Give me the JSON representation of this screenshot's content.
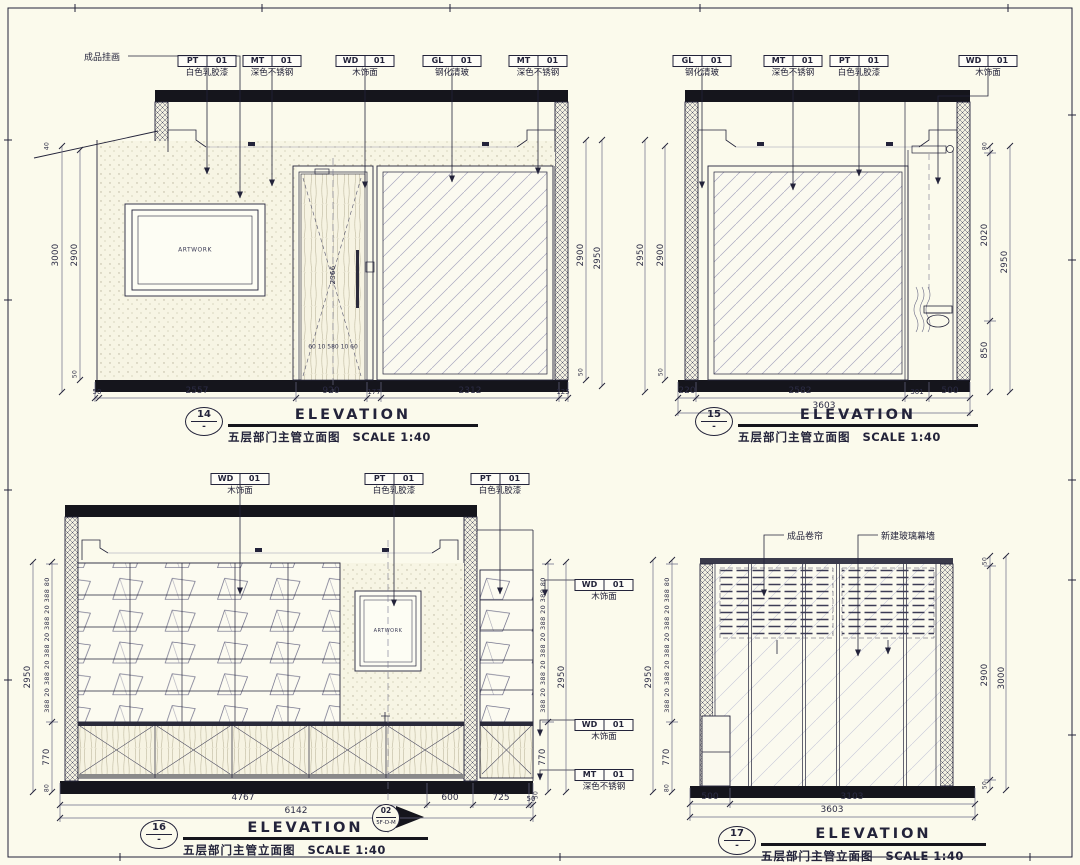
{
  "common": {
    "elevation": "ELEVATION",
    "subtitle": "五层部门主管立面图",
    "scale": "SCALE 1:40",
    "artwork": "ARTWORK"
  },
  "p14": {
    "num": "14",
    "sub": "-",
    "leader_art": "成品挂画",
    "tags": [
      {
        "code": "PT",
        "idx": "01",
        "desc": "白色乳胶漆"
      },
      {
        "code": "MT",
        "idx": "01",
        "desc": "深色不锈钢"
      },
      {
        "code": "WD",
        "idx": "01",
        "desc": "木饰面"
      },
      {
        "code": "GL",
        "idx": "01",
        "desc": "钢化清玻"
      },
      {
        "code": "MT",
        "idx": "01",
        "desc": "深色不锈钢"
      }
    ],
    "dim_left_outer": "3000",
    "dim_left_inner": "2900",
    "dim_left_top": "40",
    "dim_left_bot": "50",
    "dim_right_inner": "2900",
    "dim_right_outer": "2950",
    "dim_right_bot": "50",
    "door_h": "2366",
    "door_bottom": "60 10   580   10 60",
    "dims_bottom": [
      "50",
      "2557",
      "920",
      "177",
      "2312",
      "125"
    ]
  },
  "p15": {
    "num": "15",
    "sub": "-",
    "tags": [
      {
        "code": "GL",
        "idx": "01",
        "desc": "钢化清玻"
      },
      {
        "code": "MT",
        "idx": "01",
        "desc": "深色不锈钢"
      },
      {
        "code": "PT",
        "idx": "01",
        "desc": "白色乳胶漆"
      },
      {
        "code": "WD",
        "idx": "01",
        "desc": "木饰面"
      }
    ],
    "dim_left_outer": "2950",
    "dim_left_inner": "2900",
    "dim_left_bot": "50",
    "dim_right_top": "80",
    "dim_right_mid": "2020",
    "dim_right_low": "850",
    "dim_right_outer": "2950",
    "dims_bottom": [
      "220",
      "2582",
      "301",
      "500"
    ],
    "dim_bottom_total": "3603"
  },
  "p16": {
    "num": "16",
    "sub": "-",
    "tags_top": [
      {
        "code": "WD",
        "idx": "01",
        "desc": "木饰面"
      },
      {
        "code": "PT",
        "idx": "01",
        "desc": "白色乳胶漆"
      },
      {
        "code": "PT",
        "idx": "01",
        "desc": "白色乳胶漆"
      }
    ],
    "tags_right": [
      {
        "code": "WD",
        "idx": "01",
        "desc": "木饰面"
      },
      {
        "code": "WD",
        "idx": "01",
        "desc": "木饰面"
      },
      {
        "code": "MT",
        "idx": "01",
        "desc": "深色不锈钢"
      }
    ],
    "stack": "388 20 388 20 388 20 388 20 388 80",
    "dim_total": "2950",
    "dim_lower": "770",
    "dim_small_bot": "80",
    "dim_right_small": "50",
    "dims_bottom": [
      "4767",
      "600",
      "725",
      "50"
    ],
    "dim_bottom_total": "6142",
    "symbol_num": "02",
    "symbol_ref": "5F-D-M"
  },
  "p17": {
    "num": "17",
    "sub": "-",
    "leader_blind": "成品卷帘",
    "leader_wall": "新建玻璃幕墙",
    "stack": "388 20 388 20 388 20 388 20 388 80",
    "dim_total": "2950",
    "dim_lower": "770",
    "dim_small": "80",
    "dim_right_top": "50",
    "dim_right_inner": "2900",
    "dim_right_outer": "3000",
    "dim_right_bot": "50",
    "dims_bottom": [
      "500",
      "3103"
    ],
    "dim_bottom_total": "3603"
  }
}
